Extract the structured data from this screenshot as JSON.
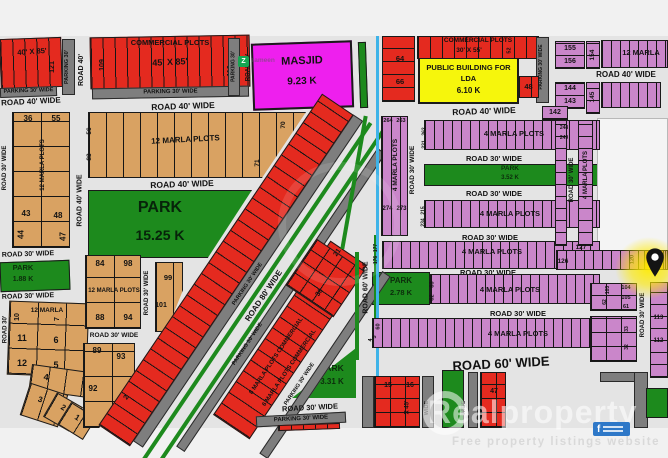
{
  "watermark": {
    "brand": "Realproperty",
    "tagline": "Free property listings website",
    "badge": "f",
    "logo_letter": "Z",
    "logo_name": "zameen"
  },
  "roads": {
    "r40": "ROAD 40' WIDE",
    "r30": "ROAD 30' WIDE",
    "r60": "ROAD 60' WIDE",
    "r80": "ROAD 80' WIDE",
    "r40s": "ROAD 40'",
    "r30s": "ROAD 30'",
    "p30": "PARKING 30'",
    "p30w": "PARKING 30' WIDE",
    "wide": "WIDE"
  },
  "areas": {
    "commercial": "COMMERCIAL PLOTS",
    "s40x85": "40' X 85'",
    "s45x85": "45' X 85'",
    "s30x55": "30' X 55'",
    "sx45": "X 45'",
    "m12": "12 MARLA PLOTS",
    "m12s": "12 MARLA",
    "m4": "4 MARLA PLOTS",
    "m10c1": "10 MARLA PLOTS",
    "m10c2": "COMMERCIAL",
    "m8c": "8 MARLA PLOTS COMMERCIAL",
    "m6c": "6 MARLA PLOTS COMMERCIAL",
    "masjid": {
      "name": "MASJID",
      "area": "9.23 K"
    },
    "public": {
      "l1": "PUBLIC BUILDING FOR",
      "l2": "LDA",
      "area": "6.10 K"
    },
    "park_main": {
      "name": "PARK",
      "area": "15.25 K"
    },
    "park188": {
      "name": "PARK",
      "area": "1.88 K"
    },
    "park278": {
      "name": "PARK",
      "area": "2.78 K"
    },
    "park331": {
      "name": "PARK",
      "area": "3.31 K"
    },
    "park352": {
      "name": "PARK",
      "area": "3.52 K"
    }
  },
  "plots": {
    "n1": "1",
    "n2": "2",
    "n3": "3",
    "n4": "4",
    "n5": "5",
    "n6": "6",
    "n7": "7",
    "n10": "10",
    "n11": "11",
    "n12": "12",
    "n15": "15",
    "n16": "16",
    "n21": "21",
    "n30": "30",
    "n32": "32",
    "n33": "33",
    "n36": "36",
    "n43": "43",
    "n44": "44",
    "n47": "47",
    "n48": "48",
    "n52": "52",
    "n55": "55",
    "n56": "56",
    "n60": "60",
    "n61": "61",
    "n62": "62",
    "n64": "64",
    "n66": "66",
    "n70": "70",
    "n71": "71",
    "n82": "82",
    "n83": "83",
    "n84": "84",
    "n88": "88",
    "n89": "89",
    "n92": "92",
    "n93": "93",
    "n94": "94",
    "n98": "98",
    "n99": "99",
    "n101": "101",
    "n103": "103",
    "n104": "104",
    "n105": "105",
    "n109": "109",
    "n112": "112",
    "n113": "113",
    "n116": "116",
    "n120": "120",
    "n121": "121",
    "n126": "126",
    "n127": "127",
    "n142": "142",
    "n143": "143",
    "n144": "144",
    "n145": "145",
    "n154": "154",
    "n155": "155",
    "n156": "156",
    "n176": "176",
    "n177": "177",
    "n215": "215",
    "n231": "231",
    "n234": "234",
    "n248": "248",
    "n249": "249",
    "n262": "262",
    "n263": "263",
    "n264": "264",
    "n273": "273",
    "n274": "274"
  }
}
